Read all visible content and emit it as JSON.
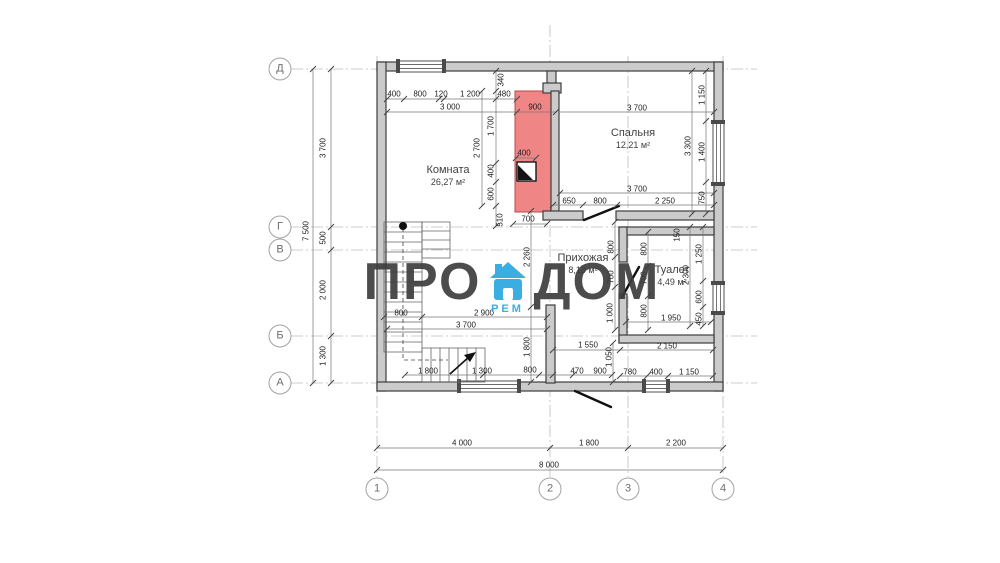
{
  "watermark": {
    "left": "ПРО",
    "right": "ДОМ",
    "sub": "РЕМ",
    "text_color": "#3d3d3d",
    "accent_color": "#2aa7e0"
  },
  "rooms": [
    {
      "id": "komnata",
      "name": "Комната",
      "area": "26,27 м²",
      "x": 448,
      "y": 176
    },
    {
      "id": "spalnya",
      "name": "Спальня",
      "area": "12,21 м²",
      "x": 633,
      "y": 139
    },
    {
      "id": "prihozhaya",
      "name": "Прихожая",
      "area": "8,13 м²",
      "x": 583,
      "y": 264
    },
    {
      "id": "tualet",
      "name": "Туалет",
      "area": "4,49 м²",
      "x": 672,
      "y": 276
    }
  ],
  "axes": {
    "rows": [
      {
        "label": "Д",
        "y": 69
      },
      {
        "label": "Г",
        "y": 227
      },
      {
        "label": "В",
        "y": 250
      },
      {
        "label": "Б",
        "y": 336
      },
      {
        "label": "А",
        "y": 383
      }
    ],
    "cols": [
      {
        "label": "1",
        "x": 377
      },
      {
        "label": "2",
        "x": 550
      },
      {
        "label": "3",
        "x": 628
      },
      {
        "label": "4",
        "x": 723
      }
    ],
    "row_circle_x": 280,
    "col_circle_y": 489
  },
  "dimensions": [
    {
      "t": "400",
      "x": 394,
      "y": 94
    },
    {
      "t": "800",
      "x": 420,
      "y": 94
    },
    {
      "t": "120",
      "x": 441,
      "y": 94
    },
    {
      "t": "1 200",
      "x": 470,
      "y": 94
    },
    {
      "t": "480",
      "x": 504,
      "y": 94
    },
    {
      "t": "3 000",
      "x": 450,
      "y": 107
    },
    {
      "t": "900",
      "x": 535,
      "y": 107
    },
    {
      "t": "340",
      "x": 501,
      "y": 80,
      "v": 1
    },
    {
      "t": "1 700",
      "x": 491,
      "y": 126,
      "v": 1
    },
    {
      "t": "2 700",
      "x": 477,
      "y": 148,
      "v": 1
    },
    {
      "t": "400",
      "x": 491,
      "y": 171,
      "v": 1
    },
    {
      "t": "600",
      "x": 491,
      "y": 194,
      "v": 1
    },
    {
      "t": "510",
      "x": 500,
      "y": 220,
      "v": 1
    },
    {
      "t": "400",
      "x": 524,
      "y": 153
    },
    {
      "t": "700",
      "x": 528,
      "y": 219
    },
    {
      "t": "3 700",
      "x": 637,
      "y": 108
    },
    {
      "t": "3 700",
      "x": 637,
      "y": 189
    },
    {
      "t": "650",
      "x": 569,
      "y": 201
    },
    {
      "t": "800",
      "x": 600,
      "y": 201
    },
    {
      "t": "2 250",
      "x": 665,
      "y": 201
    },
    {
      "t": "1 150",
      "x": 702,
      "y": 95,
      "v": 1
    },
    {
      "t": "3 300",
      "x": 688,
      "y": 146,
      "v": 1
    },
    {
      "t": "1 400",
      "x": 702,
      "y": 152,
      "v": 1
    },
    {
      "t": "750",
      "x": 702,
      "y": 198,
      "v": 1
    },
    {
      "t": "2 260",
      "x": 527,
      "y": 257,
      "v": 1
    },
    {
      "t": "800",
      "x": 401,
      "y": 313
    },
    {
      "t": "2 900",
      "x": 484,
      "y": 313
    },
    {
      "t": "3 700",
      "x": 466,
      "y": 325
    },
    {
      "t": "1 800",
      "x": 527,
      "y": 347,
      "v": 1
    },
    {
      "t": "800",
      "x": 611,
      "y": 247,
      "v": 1
    },
    {
      "t": "700",
      "x": 611,
      "y": 277,
      "v": 1
    },
    {
      "t": "1 000",
      "x": 610,
      "y": 313,
      "v": 1
    },
    {
      "t": "150",
      "x": 677,
      "y": 235,
      "v": 1
    },
    {
      "t": "800",
      "x": 644,
      "y": 249,
      "v": 1
    },
    {
      "t": "700",
      "x": 644,
      "y": 278,
      "v": 1
    },
    {
      "t": "800",
      "x": 644,
      "y": 311,
      "v": 1
    },
    {
      "t": "1 250",
      "x": 699,
      "y": 254,
      "v": 1
    },
    {
      "t": "2 300",
      "x": 686,
      "y": 275,
      "v": 1
    },
    {
      "t": "600",
      "x": 699,
      "y": 297,
      "v": 1
    },
    {
      "t": "450",
      "x": 699,
      "y": 319,
      "v": 1
    },
    {
      "t": "1 950",
      "x": 671,
      "y": 318
    },
    {
      "t": "1 550",
      "x": 588,
      "y": 345
    },
    {
      "t": "2 150",
      "x": 667,
      "y": 346
    },
    {
      "t": "1 050",
      "x": 609,
      "y": 357,
      "v": 1
    },
    {
      "t": "1 800",
      "x": 428,
      "y": 371
    },
    {
      "t": "1 300",
      "x": 482,
      "y": 371
    },
    {
      "t": "800",
      "x": 530,
      "y": 370
    },
    {
      "t": "470",
      "x": 577,
      "y": 371
    },
    {
      "t": "900",
      "x": 600,
      "y": 371
    },
    {
      "t": "780",
      "x": 630,
      "y": 372
    },
    {
      "t": "400",
      "x": 656,
      "y": 372
    },
    {
      "t": "1 150",
      "x": 689,
      "y": 372
    },
    {
      "t": "7 500",
      "x": 306,
      "y": 231,
      "v": 1
    },
    {
      "t": "3 700",
      "x": 323,
      "y": 148,
      "v": 1
    },
    {
      "t": "500",
      "x": 323,
      "y": 238,
      "v": 1
    },
    {
      "t": "2 000",
      "x": 323,
      "y": 290,
      "v": 1
    },
    {
      "t": "1 300",
      "x": 323,
      "y": 356,
      "v": 1
    },
    {
      "t": "4 000",
      "x": 462,
      "y": 443
    },
    {
      "t": "1 800",
      "x": 589,
      "y": 443
    },
    {
      "t": "2 200",
      "x": 676,
      "y": 443
    },
    {
      "t": "8 000",
      "x": 549,
      "y": 465
    }
  ],
  "colors": {
    "wall_fill": "#cbcbcb",
    "wall_stroke": "#3d3d3d",
    "red_zone": "#f08585",
    "red_zone_stroke": "#b84a4a",
    "dim_text": "#222222",
    "axis_line": "#bdbdbd",
    "watermark_text": "#3d3d3d",
    "watermark_accent": "#2aa7e0"
  }
}
